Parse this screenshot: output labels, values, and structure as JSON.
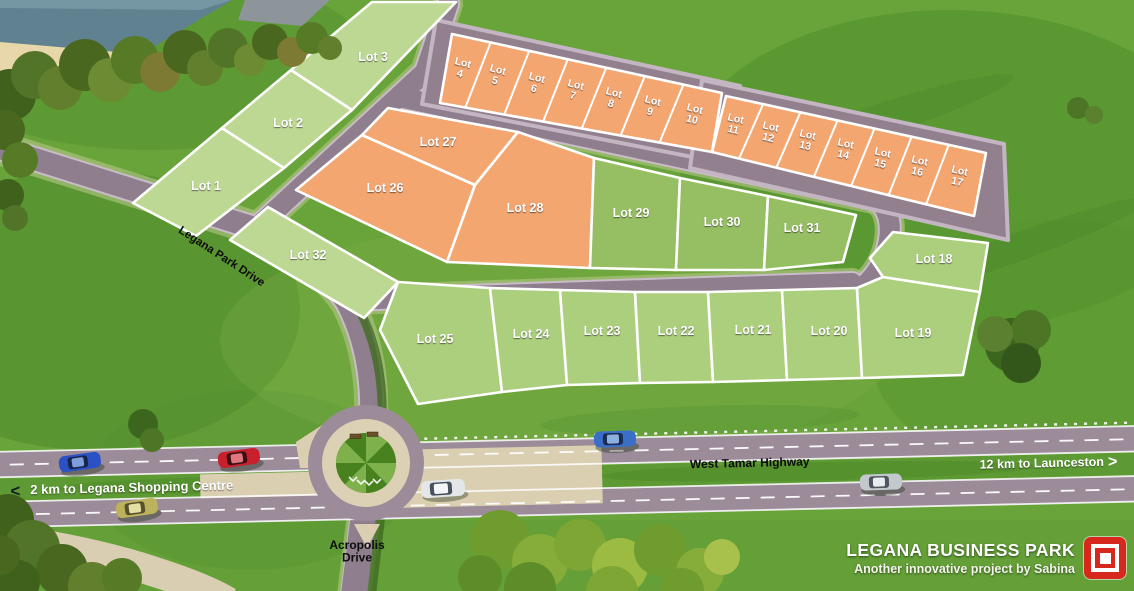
{
  "branding": {
    "title": "LEGANA BUSINESS PARK",
    "subtitle": "Another innovative project by Sabina",
    "logo_color": "#d6281c"
  },
  "road_labels": {
    "legana_park_drive": "Legana Park Drive",
    "west_tamar_highway": "West Tamar Highway",
    "acropolis_drive": "Acropolis Drive"
  },
  "directions": {
    "west": {
      "arrow": "<",
      "label": "2 km to Legana Shopping Centre"
    },
    "east": {
      "label": "12 km to Launceston",
      "arrow": ">"
    }
  },
  "lot_colors": {
    "green": "#bdd893",
    "green_mid": "#abcf7d",
    "green_dark": "#96bf63",
    "orange": "#f4a671"
  },
  "lots": [
    {
      "id": 1,
      "label": "Lot 1",
      "color": "green"
    },
    {
      "id": 2,
      "label": "Lot 2",
      "color": "green"
    },
    {
      "id": 3,
      "label": "Lot 3",
      "color": "green"
    },
    {
      "id": 4,
      "label": "Lot 4",
      "color": "orange"
    },
    {
      "id": 5,
      "label": "Lot 5",
      "color": "orange"
    },
    {
      "id": 6,
      "label": "Lot 6",
      "color": "orange"
    },
    {
      "id": 7,
      "label": "Lot 7",
      "color": "orange"
    },
    {
      "id": 8,
      "label": "Lot 8",
      "color": "orange"
    },
    {
      "id": 9,
      "label": "Lot 9",
      "color": "orange"
    },
    {
      "id": 10,
      "label": "Lot 10",
      "color": "orange"
    },
    {
      "id": 11,
      "label": "Lot 11",
      "color": "orange"
    },
    {
      "id": 12,
      "label": "Lot 12",
      "color": "orange"
    },
    {
      "id": 13,
      "label": "Lot 13",
      "color": "orange"
    },
    {
      "id": 14,
      "label": "Lot 14",
      "color": "orange"
    },
    {
      "id": 15,
      "label": "Lot 15",
      "color": "orange"
    },
    {
      "id": 16,
      "label": "Lot 16",
      "color": "orange"
    },
    {
      "id": 17,
      "label": "Lot 17",
      "color": "orange"
    },
    {
      "id": 18,
      "label": "Lot 18",
      "color": "green_mid"
    },
    {
      "id": 19,
      "label": "Lot 19",
      "color": "green_mid"
    },
    {
      "id": 20,
      "label": "Lot 20",
      "color": "green_mid"
    },
    {
      "id": 21,
      "label": "Lot 21",
      "color": "green_mid"
    },
    {
      "id": 22,
      "label": "Lot 22",
      "color": "green_mid"
    },
    {
      "id": 23,
      "label": "Lot 23",
      "color": "green_mid"
    },
    {
      "id": 24,
      "label": "Lot 24",
      "color": "green_mid"
    },
    {
      "id": 25,
      "label": "Lot 25",
      "color": "green_mid"
    },
    {
      "id": 26,
      "label": "Lot 26",
      "color": "orange"
    },
    {
      "id": 27,
      "label": "Lot 27",
      "color": "orange"
    },
    {
      "id": 28,
      "label": "Lot 28",
      "color": "orange"
    },
    {
      "id": 29,
      "label": "Lot 29",
      "color": "green_dark"
    },
    {
      "id": 30,
      "label": "Lot 30",
      "color": "green_dark"
    },
    {
      "id": 31,
      "label": "Lot 31",
      "color": "green_dark"
    },
    {
      "id": 32,
      "label": "Lot 32",
      "color": "green"
    }
  ]
}
